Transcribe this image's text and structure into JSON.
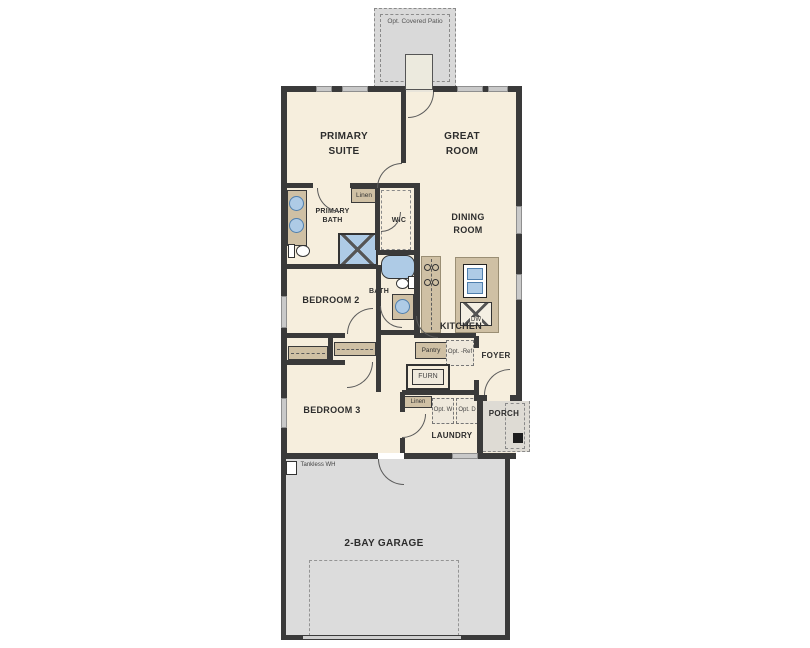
{
  "plan": {
    "labels": {
      "patio": "Opt. Covered Patio",
      "primary_suite": "PRIMARY SUITE",
      "great_room": "GREAT ROOM",
      "primary_bath": "PRIMARY BATH",
      "linen_1": "Linen",
      "wic": "WIC",
      "dining_room": "DINING ROOM",
      "bedroom_2": "BEDROOM 2",
      "bath_2": "BATH 2",
      "kitchen": "KITCHEN",
      "pantry": "Pantry",
      "opt_ref": "Opt. -Ref",
      "foyer": "FOYER",
      "furn": "FURN",
      "linen_2": "Linen",
      "opt_w": "Opt. W",
      "opt_d": "Opt. D",
      "porch": "PORCH",
      "laundry": "LAUNDRY",
      "bedroom_3": "BEDROOM 3",
      "tankless": "Tankless WH",
      "garage": "2-BAY GARAGE",
      "dw": "DW"
    },
    "colors": {
      "wall": "#3a3a3a",
      "interior_floor": "#f6eedd",
      "outdoor_gray": "#d9d9d9",
      "cabinet_tan": "#cfc0a4",
      "fixture_blue": "#aecbe6",
      "window_gray": "#c9c9c9"
    }
  }
}
